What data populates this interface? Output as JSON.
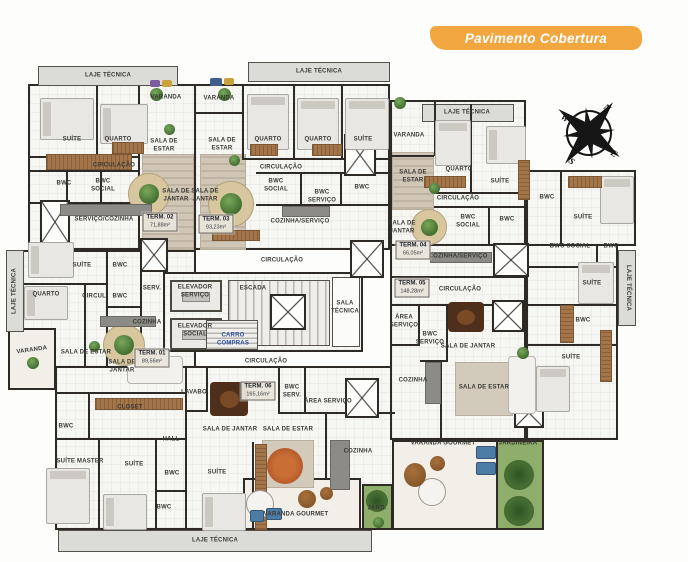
{
  "header": {
    "badge": "Pavimento Cobertura"
  },
  "compass": {
    "n": "N",
    "e": "E",
    "s": "S",
    "w": "W"
  },
  "colors": {
    "badge_bg": "#F2A640",
    "wall": "#2e2b26",
    "wood": "#a5754a",
    "greenery": "#5c8a45",
    "cart_label": "#2b4fa0"
  },
  "unit_tags": [
    {
      "id": "term-02",
      "name": "TERM. 02",
      "area": "71,88m²",
      "x": 160,
      "y": 222
    },
    {
      "id": "term-03",
      "name": "TERM. 03",
      "area": "93,23m²",
      "x": 216,
      "y": 224
    },
    {
      "id": "term-04",
      "name": "TERM. 04",
      "area": "66,05m²",
      "x": 413,
      "y": 250
    },
    {
      "id": "term-05",
      "name": "TERM. 05",
      "area": "148,28m²",
      "x": 412,
      "y": 288
    },
    {
      "id": "term-01",
      "name": "TERM. 01",
      "area": "89,56m²",
      "x": 152,
      "y": 358
    },
    {
      "id": "term-06",
      "name": "TERM. 06",
      "area": "165,16m²",
      "x": 258,
      "y": 391
    }
  ],
  "room_labels": [
    {
      "text": "LAJE TÉCNICA",
      "x": 108,
      "y": 76
    },
    {
      "text": "LAJE TÉCNICA",
      "x": 319,
      "y": 72
    },
    {
      "text": "LAJE TÉCNICA",
      "x": 467,
      "y": 113
    },
    {
      "text": "LAJE TÉCNICA",
      "x": 15,
      "y": 291,
      "rot": -90
    },
    {
      "text": "LAJE TÉCNICA",
      "x": 627,
      "y": 288,
      "rot": 90
    },
    {
      "text": "LAJE TÉCNICA",
      "x": 215,
      "y": 541
    },
    {
      "text": "SUÍTE",
      "x": 72,
      "y": 140
    },
    {
      "text": "QUARTO",
      "x": 118,
      "y": 140
    },
    {
      "text": "VARANDA",
      "x": 166,
      "y": 98
    },
    {
      "text": "SALA DE\nESTAR",
      "x": 164,
      "y": 146
    },
    {
      "text": "CIRCULAÇÃO",
      "x": 114,
      "y": 166
    },
    {
      "text": "VARANDA",
      "x": 219,
      "y": 99
    },
    {
      "text": "SALA DE\nESTAR",
      "x": 222,
      "y": 145
    },
    {
      "text": "QUARTO",
      "x": 268,
      "y": 140
    },
    {
      "text": "QUARTO",
      "x": 318,
      "y": 140
    },
    {
      "text": "SUÍTE",
      "x": 363,
      "y": 140
    },
    {
      "text": "CIRCULAÇÃO",
      "x": 281,
      "y": 168
    },
    {
      "text": "BWC",
      "x": 64,
      "y": 184
    },
    {
      "text": "BWC\nSOCIAL",
      "x": 103,
      "y": 186
    },
    {
      "text": "SERVIÇO/COZINHA",
      "x": 104,
      "y": 220
    },
    {
      "text": "SALA DE\nJANTAR",
      "x": 176,
      "y": 196
    },
    {
      "text": "SALA DE\nJANTAR",
      "x": 205,
      "y": 196
    },
    {
      "text": "BWC\nSOCIAL",
      "x": 276,
      "y": 186
    },
    {
      "text": "BWC\nSERVIÇO",
      "x": 322,
      "y": 197
    },
    {
      "text": "BWC",
      "x": 362,
      "y": 188
    },
    {
      "text": "COZINHA/SERVIÇO",
      "x": 300,
      "y": 222
    },
    {
      "text": "SUÍTE",
      "x": 82,
      "y": 266
    },
    {
      "text": "BWC",
      "x": 120,
      "y": 266
    },
    {
      "text": "SERV.",
      "x": 152,
      "y": 289
    },
    {
      "text": "QUARTO",
      "x": 46,
      "y": 295
    },
    {
      "text": "CIRCUL.",
      "x": 95,
      "y": 297
    },
    {
      "text": "BWC",
      "x": 120,
      "y": 297
    },
    {
      "text": "VARANDA",
      "x": 409,
      "y": 136
    },
    {
      "text": "SALA DE\nESTAR",
      "x": 413,
      "y": 177
    },
    {
      "text": "QUARTO",
      "x": 459,
      "y": 170
    },
    {
      "text": "SUÍTE",
      "x": 500,
      "y": 182
    },
    {
      "text": "CIRCULAÇÃO",
      "x": 458,
      "y": 199
    },
    {
      "text": "SALA DE\nJANTAR",
      "x": 402,
      "y": 228
    },
    {
      "text": "BWC\nSOCIAL",
      "x": 468,
      "y": 222
    },
    {
      "text": "BWC",
      "x": 507,
      "y": 220
    },
    {
      "text": "COZINHA/SERVIÇO",
      "x": 458,
      "y": 257
    },
    {
      "text": "CIRCULAÇÃO",
      "x": 460,
      "y": 290
    },
    {
      "text": "BWC",
      "x": 547,
      "y": 198
    },
    {
      "text": "SUÍTE",
      "x": 583,
      "y": 218
    },
    {
      "text": "BWC SOCIAL",
      "x": 570,
      "y": 247
    },
    {
      "text": "BWC",
      "x": 611,
      "y": 247
    },
    {
      "text": "SUÍTE",
      "x": 592,
      "y": 284
    },
    {
      "text": "BWC",
      "x": 583,
      "y": 321
    },
    {
      "text": "SUÍTE",
      "x": 571,
      "y": 358
    },
    {
      "text": "CIRCULAÇÃO",
      "x": 282,
      "y": 261
    },
    {
      "text": "ELEVADOR\nSERVIÇO",
      "x": 195,
      "y": 292
    },
    {
      "text": "ELEVADOR\nSOCIAL",
      "x": 195,
      "y": 331
    },
    {
      "text": "ESCADA",
      "x": 253,
      "y": 289
    },
    {
      "text": "CARRO\nCOMPRAS",
      "x": 233,
      "y": 340,
      "color": "#2b4fa0"
    },
    {
      "text": "SALA\nTÉCNICA",
      "x": 345,
      "y": 308
    },
    {
      "text": "CIRCULAÇÃO",
      "x": 266,
      "y": 362
    },
    {
      "text": "ÁREA\nSERVIÇO",
      "x": 404,
      "y": 322
    },
    {
      "text": "BWC\nSERVIÇO",
      "x": 430,
      "y": 339
    },
    {
      "text": "SALA DE JANTAR",
      "x": 468,
      "y": 347
    },
    {
      "text": "COZINHA",
      "x": 413,
      "y": 381
    },
    {
      "text": "SALA DE ESTAR",
      "x": 484,
      "y": 388
    },
    {
      "text": "VARANDA GOURMET",
      "x": 443,
      "y": 444
    },
    {
      "text": "JARDINEIRA",
      "x": 518,
      "y": 444
    },
    {
      "text": "VARANDA",
      "x": 32,
      "y": 351,
      "rot": -8
    },
    {
      "text": "SALA DE ESTAR",
      "x": 86,
      "y": 353
    },
    {
      "text": "SALA DE\nJANTAR",
      "x": 122,
      "y": 367
    },
    {
      "text": "COZINHA",
      "x": 147,
      "y": 323
    },
    {
      "text": "CLOSET",
      "x": 130,
      "y": 408
    },
    {
      "text": "BWC",
      "x": 66,
      "y": 427
    },
    {
      "text": "HALL",
      "x": 171,
      "y": 440
    },
    {
      "text": "SUÍTE MASTER",
      "x": 80,
      "y": 462
    },
    {
      "text": "SUÍTE",
      "x": 134,
      "y": 465
    },
    {
      "text": "BWC",
      "x": 172,
      "y": 474
    },
    {
      "text": "SUÍTE",
      "x": 217,
      "y": 473
    },
    {
      "text": "BWC",
      "x": 164,
      "y": 508
    },
    {
      "text": "LAVABO",
      "x": 194,
      "y": 393
    },
    {
      "text": "BWC\nSERV.",
      "x": 292,
      "y": 392
    },
    {
      "text": "ÁREA SERVIÇO",
      "x": 328,
      "y": 402
    },
    {
      "text": "SALA DE JANTAR",
      "x": 230,
      "y": 430
    },
    {
      "text": "SALA DE ESTAR",
      "x": 288,
      "y": 430
    },
    {
      "text": "COZINHA",
      "x": 358,
      "y": 452
    },
    {
      "text": "VARANDA GOURMET",
      "x": 296,
      "y": 515
    },
    {
      "text": "JARD.",
      "x": 377,
      "y": 509
    }
  ]
}
